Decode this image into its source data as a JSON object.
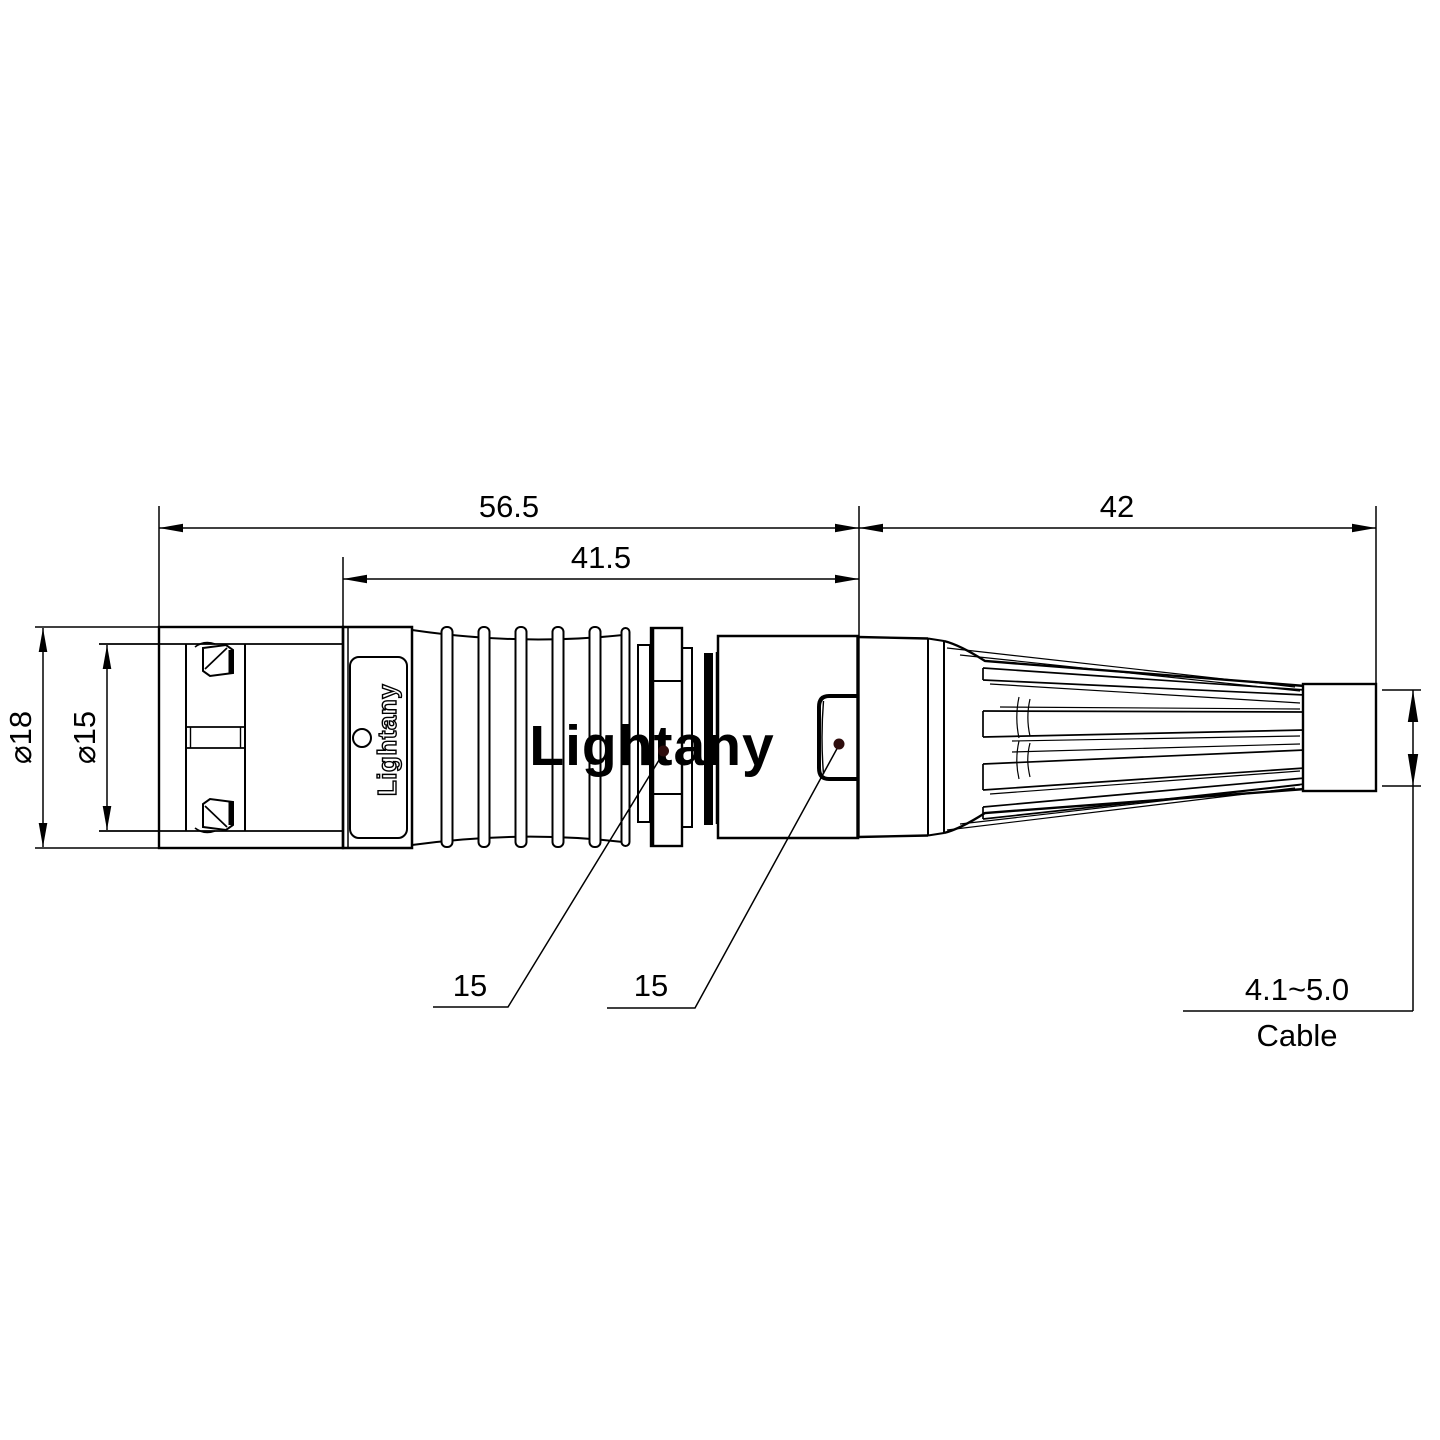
{
  "drawing": {
    "dimensions": {
      "overall_length": "56.5",
      "grip_length": "41.5",
      "boot_length": "42",
      "outer_diameter": "⌀18",
      "front_diameter": "⌀15",
      "collar_ref": "15",
      "backshell_ref": "15",
      "cable_range": "4.1~5.0",
      "cable_caption": "Cable"
    },
    "branding": {
      "body_marking": "Lightany",
      "watermark": "Lightany"
    },
    "colors": {
      "line": "#000000",
      "watermark": "#efb3b3",
      "leader_dot": "#2e0d0d",
      "background": "#ffffff"
    }
  }
}
